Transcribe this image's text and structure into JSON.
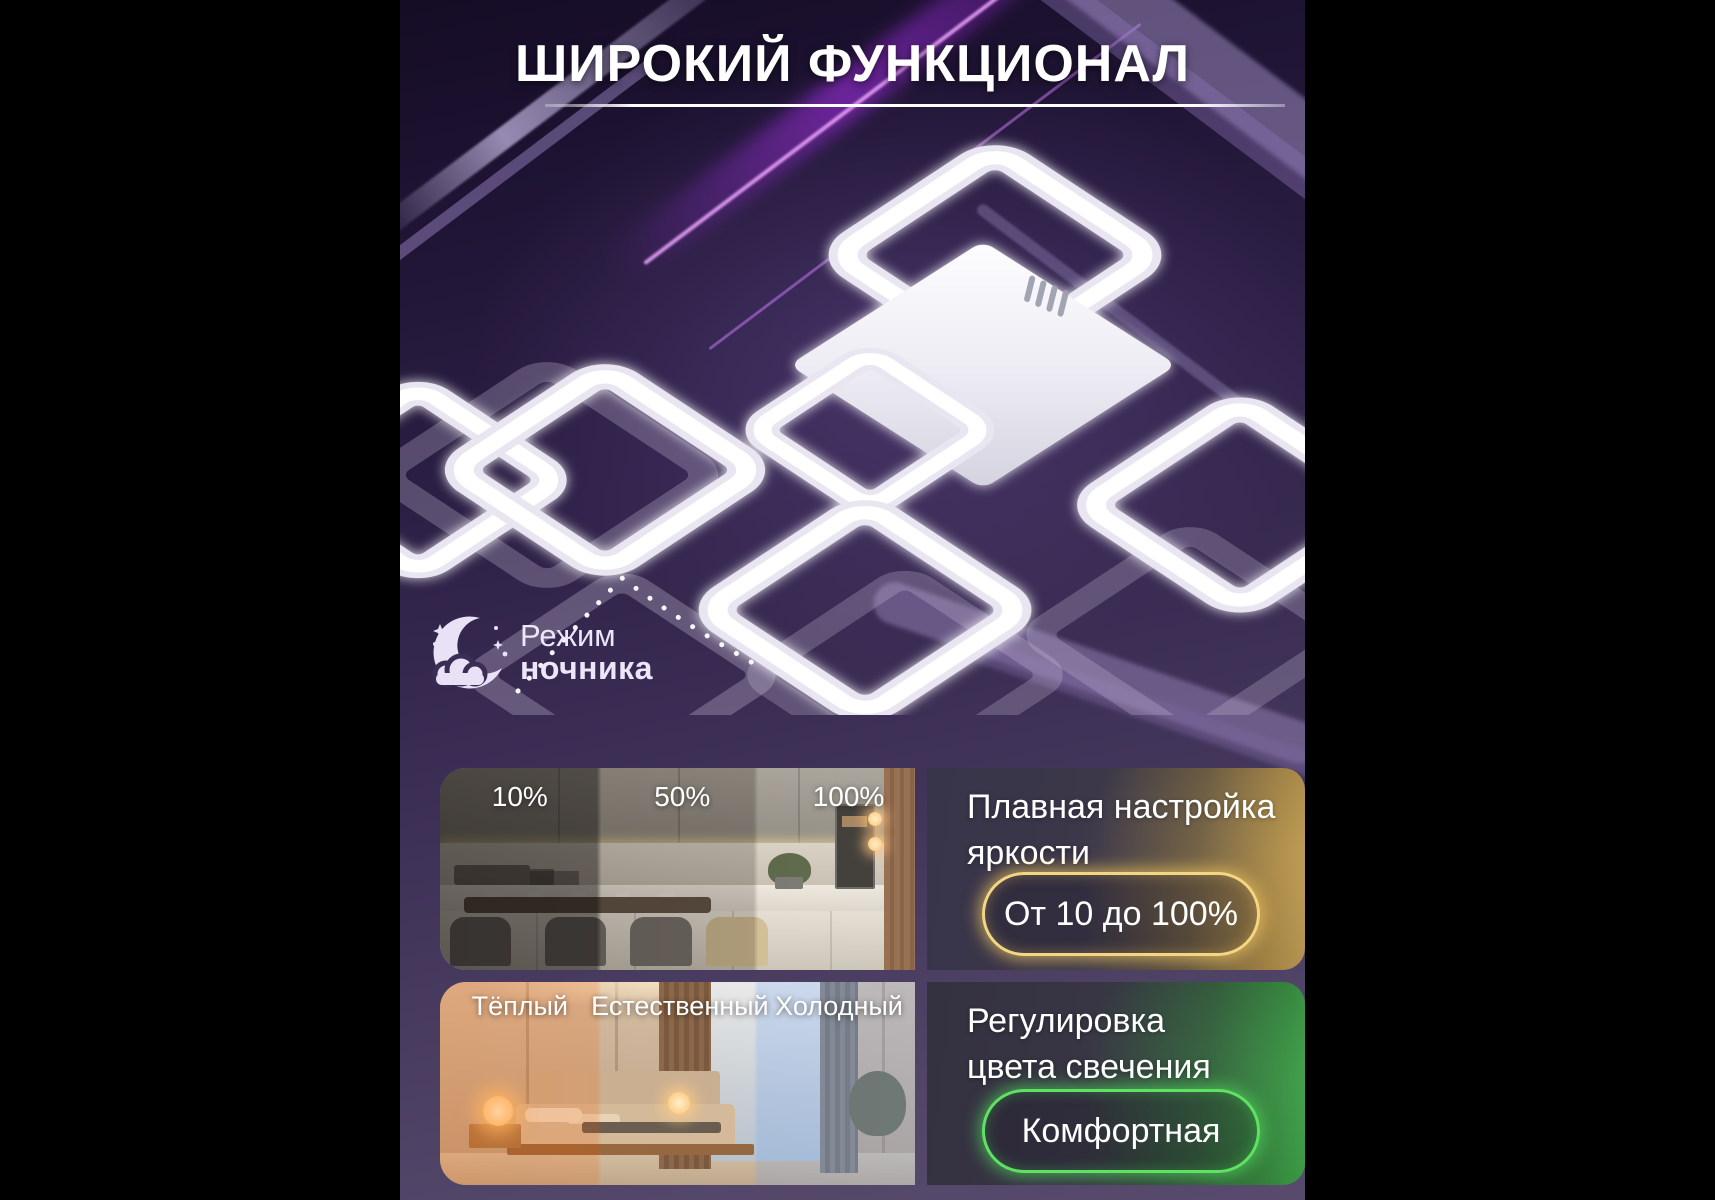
{
  "poster": {
    "title": "ШИРОКИЙ ФУНКЦИОНАЛ"
  },
  "night_mode": {
    "icon": "moon-with-cloud",
    "line1": "Режим",
    "line2": "ночника"
  },
  "brightness": {
    "labels": [
      "10%",
      "50%",
      "100%"
    ],
    "heading_line1": "Плавная настройка",
    "heading_line2": "яркости",
    "badge": "От 10 до 100%",
    "accent_color": "#f3d684"
  },
  "color_temperature": {
    "labels": [
      "Тёплый",
      "Естественный",
      "Холодный"
    ],
    "heading_line1": "Регулировка",
    "heading_line2": "цвета свечения",
    "badge": "Комфортная",
    "accent_color": "#5fe262"
  }
}
